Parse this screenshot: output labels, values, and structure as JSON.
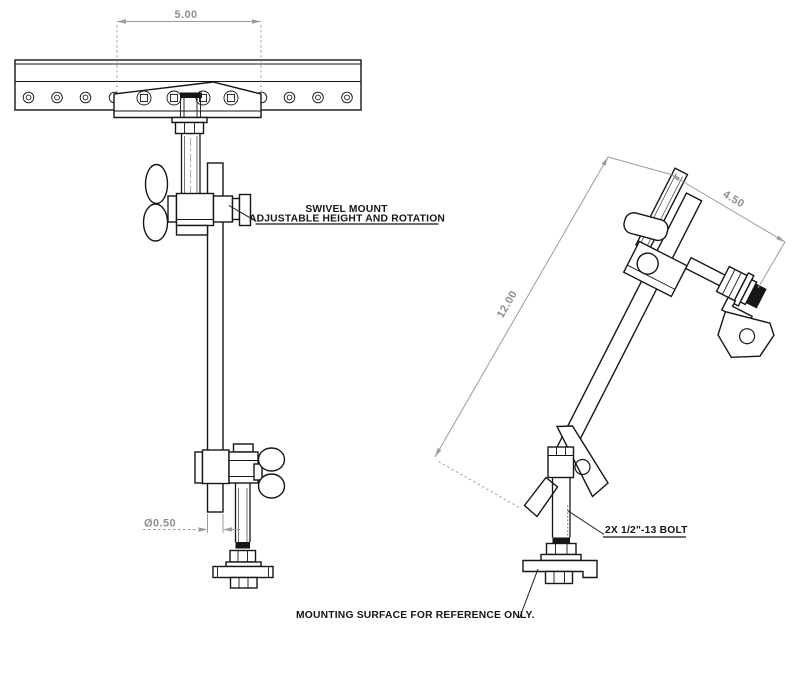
{
  "title": "Swivel mount assembly engineering drawing",
  "colors": {
    "background": "#ffffff",
    "object_line": "#161616",
    "dimension_line": "#9b9b9b",
    "dimension_text": "#8f8f8f"
  },
  "front_view": {
    "dim_rail_width": "5.00",
    "dim_tube_diameter": "Ø0.50",
    "callout_swivel_line1": "SWIVEL MOUNT",
    "callout_swivel_line2": "ADJUSTABLE HEIGHT AND ROTATION"
  },
  "side_view": {
    "dim_length": "12.00",
    "dim_offset": "4.50",
    "callout_bolt": "2X 1/2\"-13 BOLT",
    "callout_surface": "MOUNTING SURFACE FOR REFERENCE ONLY."
  }
}
